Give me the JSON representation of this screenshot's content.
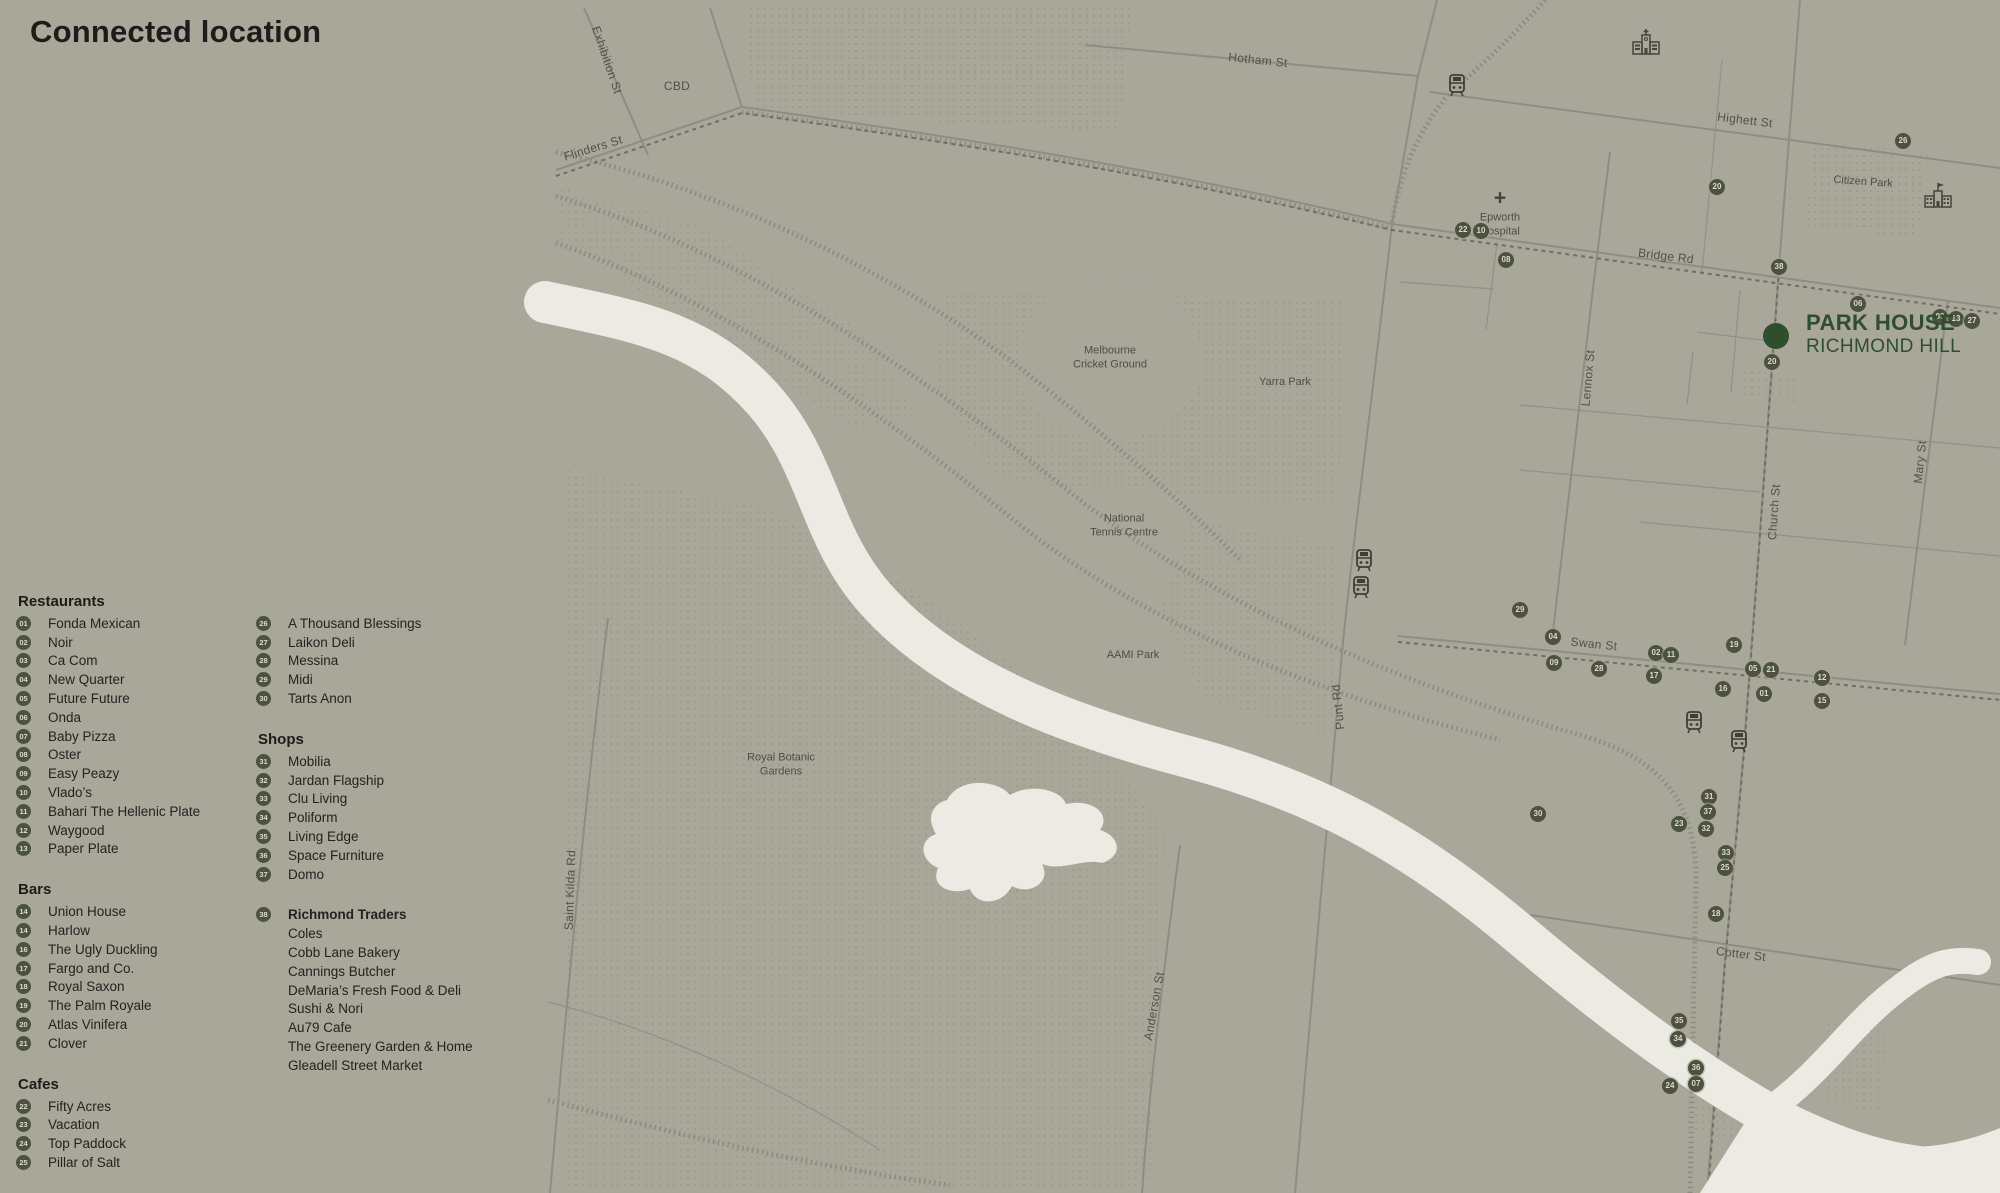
{
  "title": "Connected location",
  "colors": {
    "bg": "#a8a79a",
    "badge-bg": "#4d5240",
    "badge-fg": "#dbdacb",
    "green": "#2e4e2d",
    "river": "#ebeae3",
    "road": "#8e8d83",
    "dots": "#90907f",
    "text": "#1c1c1a"
  },
  "legend": {
    "columns": [
      {
        "x": 16,
        "y": 592,
        "sections": [
          {
            "name": "Restaurants",
            "items": [
              {
                "num": "01",
                "label": "Fonda Mexican"
              },
              {
                "num": "02",
                "label": "Noir"
              },
              {
                "num": "03",
                "label": "Ca Com"
              },
              {
                "num": "04",
                "label": "New Quarter"
              },
              {
                "num": "05",
                "label": "Future Future"
              },
              {
                "num": "06",
                "label": "Onda"
              },
              {
                "num": "07",
                "label": "Baby Pizza"
              },
              {
                "num": "08",
                "label": "Oster"
              },
              {
                "num": "09",
                "label": "Easy Peazy"
              },
              {
                "num": "10",
                "label": "Vlado’s"
              },
              {
                "num": "11",
                "label": "Bahari The Hellenic Plate"
              },
              {
                "num": "12",
                "label": "Waygood"
              },
              {
                "num": "13",
                "label": "Paper Plate"
              }
            ]
          },
          {
            "name": "Bars",
            "items": [
              {
                "num": "14",
                "label": "Union House"
              },
              {
                "num": "14",
                "label": "Harlow"
              },
              {
                "num": "16",
                "label": "The Ugly Duckling"
              },
              {
                "num": "17",
                "label": "Fargo and Co."
              },
              {
                "num": "18",
                "label": "Royal Saxon"
              },
              {
                "num": "19",
                "label": "The Palm Royale"
              },
              {
                "num": "20",
                "label": "Atlas Vinifera"
              },
              {
                "num": "21",
                "label": "Clover"
              }
            ]
          },
          {
            "name": "Cafes",
            "items": [
              {
                "num": "22",
                "label": "Fifty Acres"
              },
              {
                "num": "23",
                "label": "Vacation"
              },
              {
                "num": "24",
                "label": "Top Paddock"
              },
              {
                "num": "25",
                "label": "Pillar of Salt"
              }
            ]
          }
        ]
      },
      {
        "x": 256,
        "y": 614,
        "sections": [
          {
            "name": null,
            "items": [
              {
                "num": "26",
                "label": "A Thousand Blessings"
              },
              {
                "num": "27",
                "label": "Laikon Deli"
              },
              {
                "num": "28",
                "label": "Messina"
              },
              {
                "num": "29",
                "label": "Midi"
              },
              {
                "num": "30",
                "label": "Tarts Anon"
              }
            ]
          },
          {
            "name": "Shops",
            "items": [
              {
                "num": "31",
                "label": "Mobilia"
              },
              {
                "num": "32",
                "label": "Jardan Flagship"
              },
              {
                "num": "33",
                "label": "Clu Living"
              },
              {
                "num": "34",
                "label": "Poliform"
              },
              {
                "num": "35",
                "label": "Living Edge"
              },
              {
                "num": "36",
                "label": "Space Furniture"
              },
              {
                "num": "37",
                "label": "Domo"
              }
            ]
          },
          {
            "name": null,
            "gap": 22,
            "items": [
              {
                "num": "38",
                "label": "Richmond Traders",
                "bold": true
              },
              {
                "label": "Coles"
              },
              {
                "label": "Cobb Lane Bakery"
              },
              {
                "label": "Cannings Butcher"
              },
              {
                "label": "DeMaria’s Fresh Food & Deli"
              },
              {
                "label": "Sushi & Nori"
              },
              {
                "label": "Au79 Cafe"
              },
              {
                "label": "The Greenery Garden & Home"
              },
              {
                "label": "Gleadell Street Market"
              }
            ]
          }
        ]
      }
    ]
  },
  "map": {
    "park_house": {
      "line1": "PARK HOUSE",
      "line2": "RICHMOND HILL",
      "dot_x": 1776,
      "dot_y": 336,
      "label_x": 1806,
      "label_y": 310
    },
    "street_labels": [
      {
        "text": "Exhibition St",
        "x": 607,
        "y": 60,
        "rot": 71
      },
      {
        "text": "Flinders St",
        "x": 593,
        "y": 148,
        "rot": -17
      },
      {
        "text": "CBD",
        "x": 677,
        "y": 86,
        "rot": 0
      },
      {
        "text": "Hotham St",
        "x": 1258,
        "y": 60,
        "rot": 6
      },
      {
        "text": "Highett St",
        "x": 1745,
        "y": 120,
        "rot": 7
      },
      {
        "text": "Bridge Rd",
        "x": 1666,
        "y": 256,
        "rot": 7
      },
      {
        "text": "Swan St",
        "x": 1594,
        "y": 644,
        "rot": 6
      },
      {
        "text": "Cotter St",
        "x": 1741,
        "y": 954,
        "rot": 7
      },
      {
        "text": "Punt Rd",
        "x": 1338,
        "y": 707,
        "rot": -96
      },
      {
        "text": "Lennox St",
        "x": 1588,
        "y": 378,
        "rot": -85
      },
      {
        "text": "Church St",
        "x": 1774,
        "y": 512,
        "rot": -86
      },
      {
        "text": "Mary St",
        "x": 1920,
        "y": 462,
        "rot": -84
      },
      {
        "text": "Anderson St",
        "x": 1154,
        "y": 1006,
        "rot": -80
      },
      {
        "text": "Saint Kilda Rd",
        "x": 570,
        "y": 890,
        "rot": -88
      }
    ],
    "place_labels": [
      {
        "lines": [
          "Epworth",
          "Hospital"
        ],
        "x": 1500,
        "y": 214,
        "icon": "hospital-cross"
      },
      {
        "lines": [
          "Citizen Park"
        ],
        "x": 1863,
        "y": 182,
        "rot": 4
      },
      {
        "lines": [
          "Melbourne",
          "Cricket Ground"
        ],
        "x": 1110,
        "y": 358
      },
      {
        "lines": [
          "Yarra Park"
        ],
        "x": 1285,
        "y": 382
      },
      {
        "lines": [
          "National",
          "Tennis Centre"
        ],
        "x": 1124,
        "y": 526
      },
      {
        "lines": [
          "AAMI Park"
        ],
        "x": 1133,
        "y": 655
      },
      {
        "lines": [
          "Royal Botanic",
          "Gardens"
        ],
        "x": 781,
        "y": 765
      }
    ],
    "markers": [
      {
        "num": "26",
        "x": 1903,
        "y": 141
      },
      {
        "num": "20",
        "x": 1717,
        "y": 187
      },
      {
        "num": "22",
        "x": 1463,
        "y": 230
      },
      {
        "num": "10",
        "x": 1481,
        "y": 231
      },
      {
        "num": "08",
        "x": 1506,
        "y": 260
      },
      {
        "num": "38",
        "x": 1779,
        "y": 267
      },
      {
        "num": "06",
        "x": 1858,
        "y": 304
      },
      {
        "num": "03",
        "x": 1940,
        "y": 317
      },
      {
        "num": "13",
        "x": 1956,
        "y": 319
      },
      {
        "num": "27",
        "x": 1972,
        "y": 321
      },
      {
        "num": "20",
        "x": 1772,
        "y": 362
      },
      {
        "num": "29",
        "x": 1520,
        "y": 610
      },
      {
        "num": "04",
        "x": 1553,
        "y": 637
      },
      {
        "num": "09",
        "x": 1554,
        "y": 663
      },
      {
        "num": "02",
        "x": 1656,
        "y": 653
      },
      {
        "num": "11",
        "x": 1671,
        "y": 655
      },
      {
        "num": "28",
        "x": 1599,
        "y": 669
      },
      {
        "num": "17",
        "x": 1654,
        "y": 676
      },
      {
        "num": "19",
        "x": 1734,
        "y": 645
      },
      {
        "num": "05",
        "x": 1753,
        "y": 669
      },
      {
        "num": "21",
        "x": 1771,
        "y": 670
      },
      {
        "num": "16",
        "x": 1723,
        "y": 689
      },
      {
        "num": "01",
        "x": 1764,
        "y": 694
      },
      {
        "num": "12",
        "x": 1822,
        "y": 678
      },
      {
        "num": "15",
        "x": 1822,
        "y": 701
      },
      {
        "num": "30",
        "x": 1538,
        "y": 814
      },
      {
        "num": "31",
        "x": 1709,
        "y": 797
      },
      {
        "num": "37",
        "x": 1708,
        "y": 812
      },
      {
        "num": "23",
        "x": 1679,
        "y": 824
      },
      {
        "num": "32",
        "x": 1706,
        "y": 829
      },
      {
        "num": "33",
        "x": 1726,
        "y": 853
      },
      {
        "num": "25",
        "x": 1725,
        "y": 868
      },
      {
        "num": "18",
        "x": 1716,
        "y": 914
      },
      {
        "num": "35",
        "x": 1679,
        "y": 1021
      },
      {
        "num": "34",
        "x": 1678,
        "y": 1039
      },
      {
        "num": "36",
        "x": 1696,
        "y": 1068
      },
      {
        "num": "24",
        "x": 1670,
        "y": 1086
      },
      {
        "num": "07",
        "x": 1696,
        "y": 1084
      }
    ],
    "poi_icons": [
      {
        "type": "train-station",
        "x": 1457,
        "y": 85
      },
      {
        "type": "train-station",
        "x": 1364,
        "y": 560
      },
      {
        "type": "train-station",
        "x": 1361,
        "y": 587
      },
      {
        "type": "train-station",
        "x": 1694,
        "y": 722
      },
      {
        "type": "train-station",
        "x": 1739,
        "y": 741
      },
      {
        "type": "church",
        "x": 1646,
        "y": 42
      },
      {
        "type": "school",
        "x": 1938,
        "y": 196
      }
    ]
  }
}
